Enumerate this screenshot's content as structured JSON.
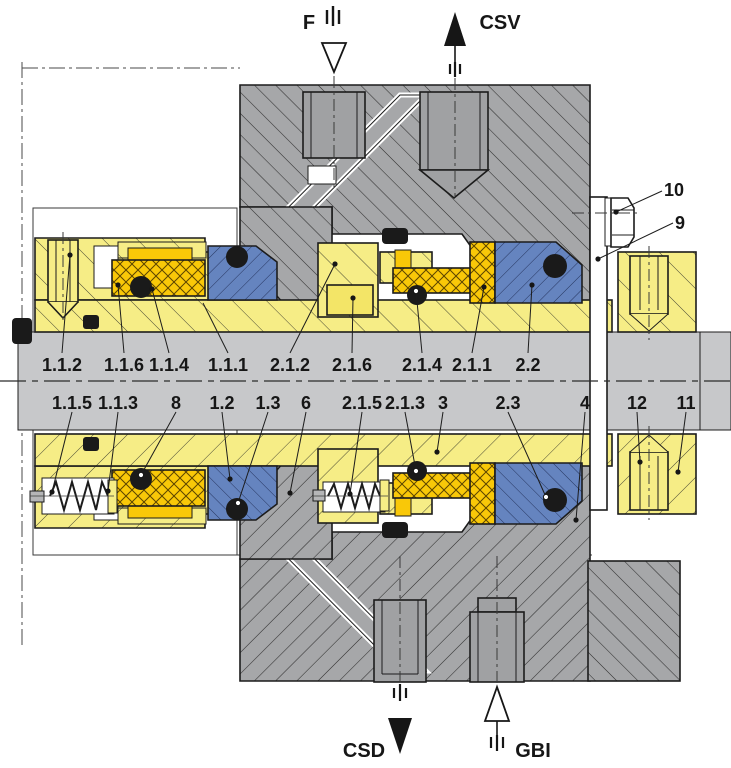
{
  "drawing": {
    "kind": "technical-cross-section",
    "subject": "dual mechanical seal cartridge"
  },
  "ports": {
    "f": {
      "label": "F"
    },
    "csv": {
      "label": "CSV"
    },
    "csd": {
      "label": "CSD"
    },
    "gbi": {
      "label": "GBI"
    }
  },
  "part_labels": {
    "upper": [
      "1.1.2",
      "1.1.6",
      "1.1.4",
      "1.1.1",
      "2.1.2",
      "2.1.6",
      "2.1.4",
      "2.1.1",
      "2.2"
    ],
    "lower": [
      "1.1.5",
      "1.1.3",
      "8",
      "1.2",
      "1.3",
      "6",
      "2.1.5",
      "2.1.3",
      "3",
      "2.3",
      "4",
      "12",
      "11"
    ],
    "side": [
      "10",
      "9"
    ]
  },
  "colors": {
    "housing_gray": "#a6a7a9",
    "shaft_gray": "#c7c8ca",
    "gland_yellow": "#f6ed86",
    "face_gold": "#f9c808",
    "ring_blue": "#6584bf",
    "oring_black": "#1a1a1a",
    "line": "#1c1c1c"
  }
}
